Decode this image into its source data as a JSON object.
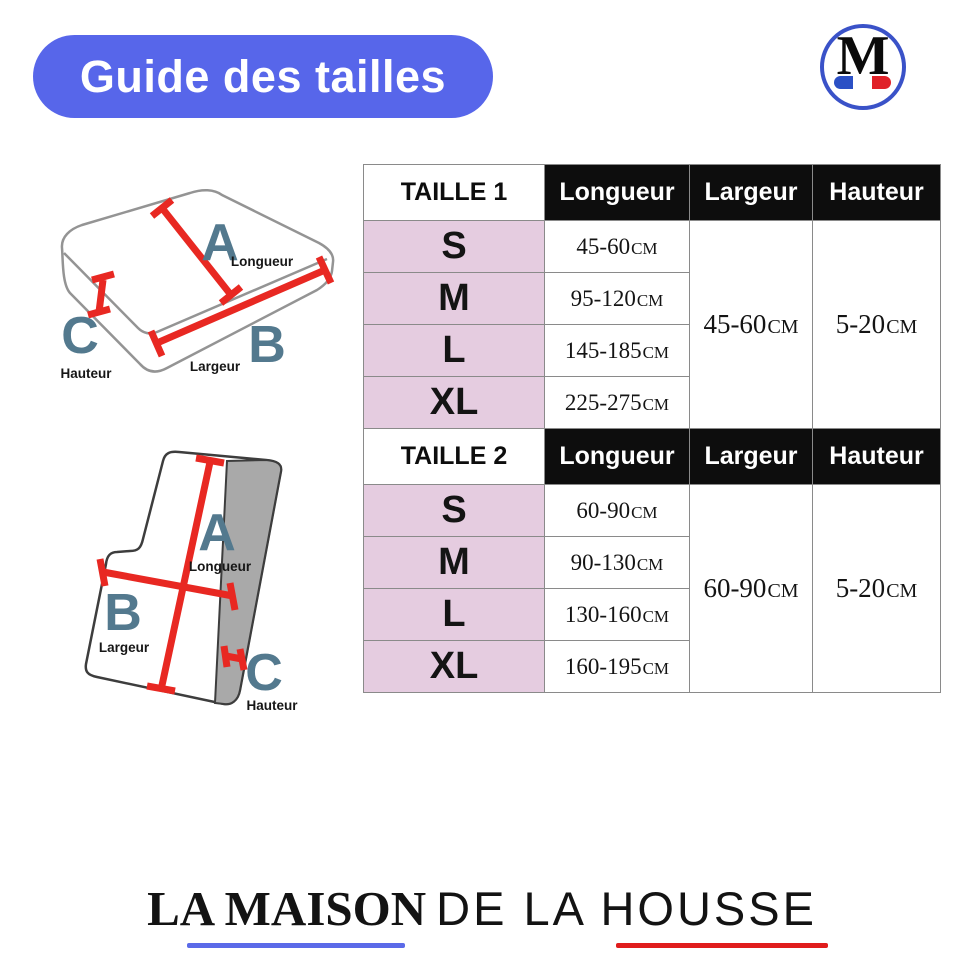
{
  "page": {
    "width": 964,
    "height": 967,
    "background": "#ffffff"
  },
  "header": {
    "title": "Guide des tailles",
    "logo_letter": "M"
  },
  "diagrams": [
    {
      "id": "seat-cushion",
      "labels": [
        {
          "letter": "A",
          "dimension": "Longueur"
        },
        {
          "letter": "B",
          "dimension": "Largeur"
        },
        {
          "letter": "C",
          "dimension": "Hauteur"
        }
      ]
    },
    {
      "id": "backrest-cushion",
      "labels": [
        {
          "letter": "A",
          "dimension": "Longueur"
        },
        {
          "letter": "B",
          "dimension": "Largeur"
        },
        {
          "letter": "C",
          "dimension": "Hauteur"
        }
      ]
    }
  ],
  "tables": [
    {
      "title": "TAILLE 1",
      "columns": [
        "Longueur",
        "Largeur",
        "Hauteur"
      ],
      "unit": "CM",
      "rows": [
        {
          "size": "S",
          "longueur": "45-60"
        },
        {
          "size": "M",
          "longueur": "95-120"
        },
        {
          "size": "L",
          "longueur": "145-185"
        },
        {
          "size": "XL",
          "longueur": "225-275"
        }
      ],
      "largeur": "45-60",
      "hauteur": "5-20"
    },
    {
      "title": "TAILLE 2",
      "columns": [
        "Longueur",
        "Largeur",
        "Hauteur"
      ],
      "unit": "CM",
      "rows": [
        {
          "size": "S",
          "longueur": "60-90"
        },
        {
          "size": "M",
          "longueur": "90-130"
        },
        {
          "size": "L",
          "longueur": "130-160"
        },
        {
          "size": "XL",
          "longueur": "160-195"
        }
      ],
      "largeur": "60-90",
      "hauteur": "5-20"
    }
  ],
  "footer": {
    "brand_serif": "LA MAISON",
    "brand_sans": "DE LA HOUSSE"
  },
  "colors": {
    "pill_blue": "#5766ea",
    "table_pink": "#e5cce0",
    "table_header_black": "#0d0d0d",
    "diagram_letter_blue": "#53798e",
    "arrow_red": "#e82822",
    "flag_blue": "#2b50c5",
    "flag_red": "#e02128",
    "underline_blue": "#5b6ae8",
    "underline_red": "#e01d1d",
    "logo_ring_blue": "#3a52c8"
  }
}
